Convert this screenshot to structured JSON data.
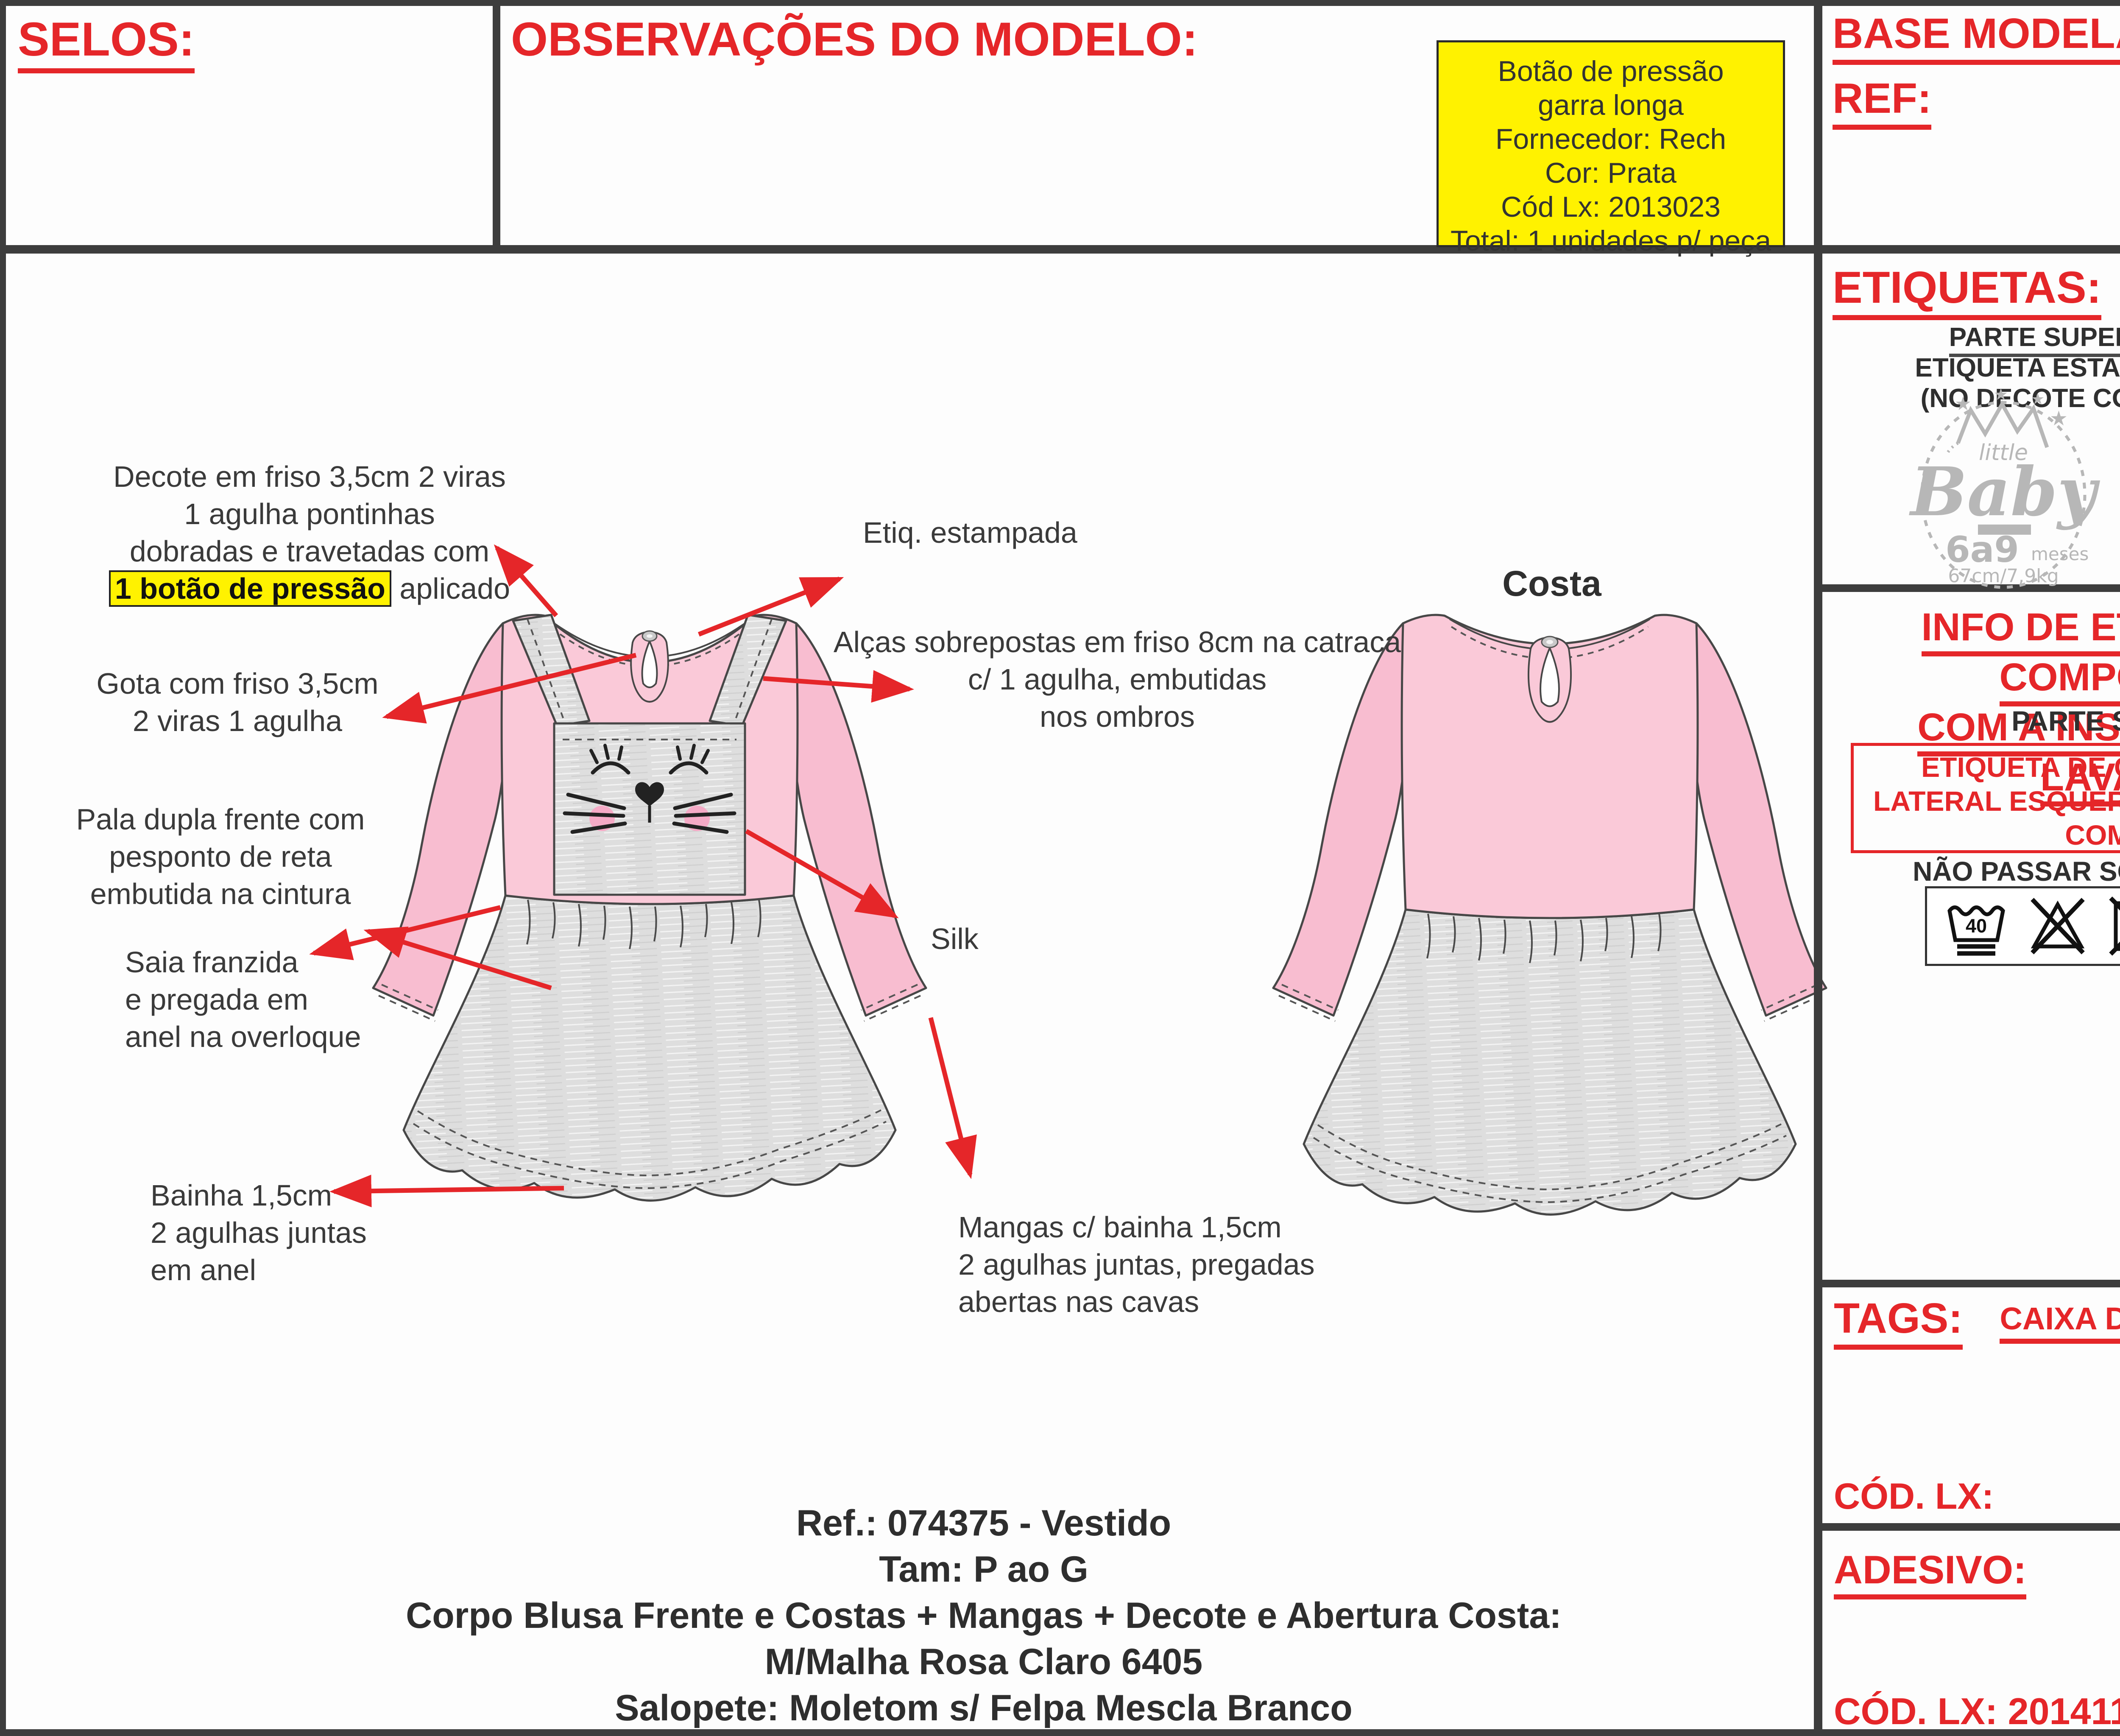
{
  "header": {
    "selos_label": "SELOS:",
    "observacoes_label": "OBSERVAÇÕES DO MODELO:",
    "yellow_note": "Botão de pressão\ngarra longa\nFornecedor: Rech\nCor: Prata\nCód Lx: 2013023\nTotal: 1 unidades p/ peça",
    "base_modelagem_label": "BASE MODELAGEM:",
    "ref_label": "REF:"
  },
  "etiquetas": {
    "title": "ETIQUETAS:",
    "line1": "PARTE SUPERIOR",
    "line2": "ETIQUETA ESTAMPADA",
    "line3": "(NO DECOTE COSTAS)",
    "logo": {
      "little": "little",
      "baby": "Baby",
      "size_range": "6a9",
      "meses": "meses",
      "measurements": "67cm/7,9kg"
    }
  },
  "info_etiqueta": {
    "title_line1": "INFO DE ETIQUETA DE COMPOSIÇÃO",
    "title_line2": "COM A INSTRUÇÃO DE LAVAGEM",
    "subtitle": "PARTE SUPERIOR",
    "box_text": "ETIQUETA DE COMPOSIÇÃO NA\nLATERAL ESQUERDA DE QUEM VESTE\nCOM CNPJ",
    "warning": "NÃO PASSAR SOBRE A ESTAMPA",
    "wash_temp": "40",
    "care_icons": [
      "wash-40-icon",
      "no-bleach-icon",
      "no-tumble-dry-icon",
      "drip-dry-icon",
      "iron-low-icon",
      "no-dry-clean-icon"
    ]
  },
  "tags_section": {
    "title": "TAGS:",
    "caixa": "CAIXA DE FÓSFORO:",
    "cod_lx_label": "CÓD. LX:"
  },
  "adesivo_section": {
    "title": "ADESIVO:",
    "cod_lx": "CÓD. LX: 20141185"
  },
  "drawing": {
    "costa_label": "Costa",
    "annotations": {
      "decote": "Decote em friso 3,5cm 2 viras\n1 agulha  pontinhas\ndobradas e travetadas com",
      "decote_highlight": "1 botão de pressão",
      "decote_suffix": " aplicado",
      "etiq": "Etiq. estampada",
      "alcas": "Alças sobrepostas em friso 8cm na catraca\nc/ 1 agulha, embutidas\nnos ombros",
      "gota": "Gota com friso 3,5cm\n2 viras 1 agulha",
      "pala": "Pala dupla frente com\npesponto de reta\nembutida na cintura",
      "saia": "Saia franzida\ne pregada em\nanel na overloque",
      "bainha": "Bainha 1,5cm\n2 agulhas juntas\nem anel",
      "silk": "Silk",
      "mangas": "Mangas c/ bainha 1,5cm\n2 agulhas juntas, pregadas\nabertas nas cavas"
    }
  },
  "footer": {
    "line1": "Ref.: 074375 - Vestido",
    "line2": "Tam: P ao G",
    "line3": "Corpo Blusa Frente e Costas + Mangas + Decote e Abertura Costa:",
    "line4": "M/Malha Rosa Claro 6405",
    "line5": "Salopete: Moletom s/ Felpa Mescla Branco"
  },
  "colors": {
    "accent_red": "#e52629",
    "highlight_yellow": "#fff200",
    "fabric_pink": "#fac9d8",
    "fabric_pink_dark": "#f8bdd0",
    "fabric_gray": "#dedede",
    "line_dark": "#3d3d3d"
  }
}
